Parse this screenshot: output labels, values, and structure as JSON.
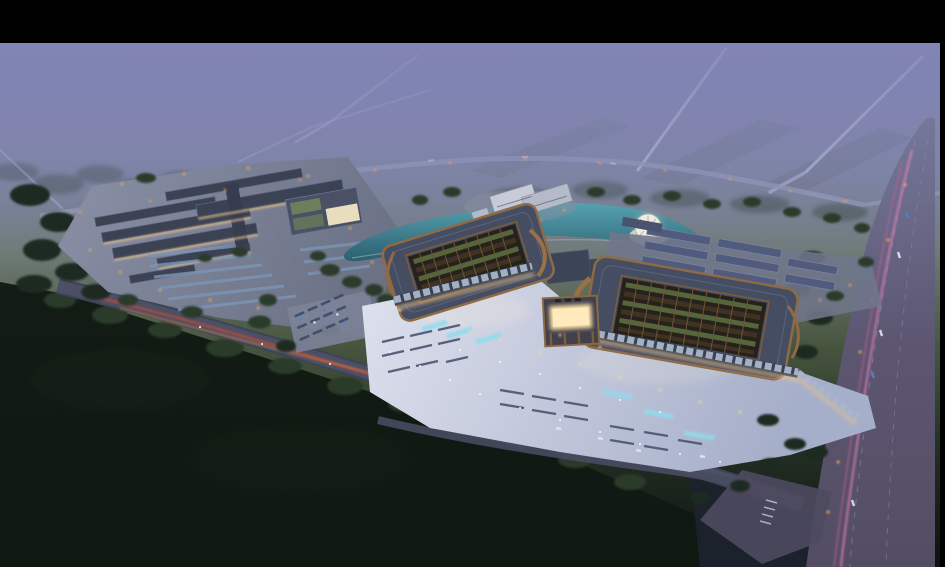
{
  "canvas": {
    "width": 945,
    "height": 567
  },
  "scene": {
    "kind": "aerial architectural rendering",
    "time_of_day": "dusk",
    "alt": "Bird's-eye dusk rendering of an illuminated market campus: twin curved-roof pavilions with rooftop garden courtyards and a glowing central gate, a bright entry plaza with parking rows, a smaller market-hall complex to the west, a pond with a circular fountain plaza, dormitory rows, dark tree belts and fields, a diagonal avenue with red car-light trails and a wide highway with pink light trails, letterboxed with black bars."
  },
  "features": [
    "letterbox-top-bar",
    "letterbox-right-bar",
    "misty-horizon",
    "distant-roads",
    "west-market-complex",
    "market-parking-lot",
    "shuttle-parking-lot",
    "twin-pavilion-hall",
    "west-pavilion",
    "east-pavilion",
    "entrance-gate",
    "entry-plaza",
    "plaza-fountain-strips",
    "pond",
    "circular-fountain-plaza",
    "dormitory-rows",
    "office-building",
    "north-service-road",
    "south-avenue",
    "east-highway",
    "road-junction",
    "tree-belts",
    "dark-fields"
  ],
  "palette": {
    "letterbox": "#000000",
    "sky_top": "#8083b3",
    "sky_mid": "#7d849e",
    "land_mist": "#6e7a74",
    "land_green": "#47553f",
    "field_dark": "#232e24",
    "field_black": "#0c120e",
    "fog": "#8184b4",
    "road_mist": "#b7bad4",
    "plaza_light": "#dcdfec",
    "plaza_shade": "#a6afc9",
    "pond_light": "#57a7b5",
    "pond_deep": "#2a5f70",
    "highway_top": "#75789a",
    "highway_mid": "#5c5671",
    "highway_low": "#534d64",
    "avenue_grey": "#3f4356",
    "roof_slate": "#454d63",
    "roof_copper": "#8f6a44",
    "courtyard_dark": "#26211a",
    "courtyard_green": "#55653c",
    "gate_glow": "#f6dda6",
    "facade_warm": "#eec488",
    "dorm_roof": "#505b7d",
    "parking_blue": "#7b95b6",
    "streak_red": "#cf4a2e",
    "streak_orange": "#e08a3a",
    "streak_pink": "#e27db4",
    "lamp_warm": "#ffb05a",
    "lamp_white": "#ffffff",
    "tree_dark": "#1d2a21"
  }
}
